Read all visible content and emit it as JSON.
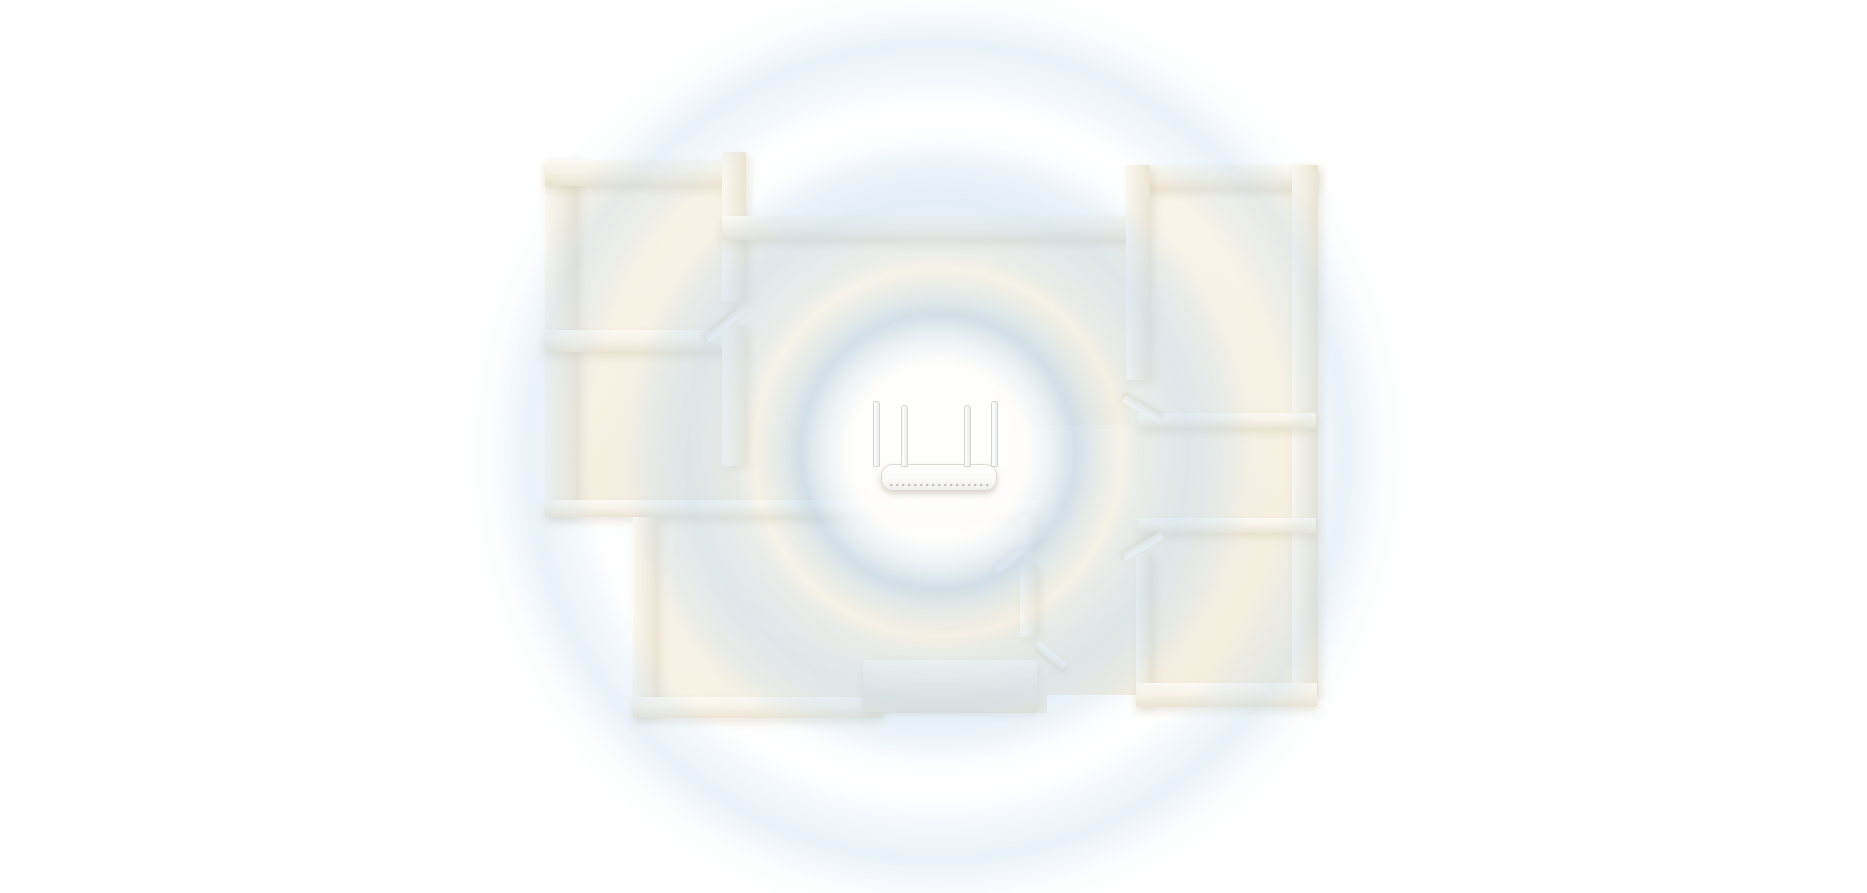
{
  "meta": {
    "description": "Top-down 3D floor plan of an apartment with a white dual-band WiFi router placed in the central room, radiating concentric light-blue wireless signal rings that cover every room. No text is present in the image.",
    "canvas": {
      "width": 1867,
      "height": 893
    },
    "background": "#ffffff"
  },
  "palette": {
    "floor": "#f7f0df",
    "floor_bright": "#fdf8ec",
    "wall_top": "#faf6ec",
    "wall_side": "#e9e1cc",
    "wall_shadow": "rgba(188,174,140,0.3)",
    "signal_blue": "#c5ddf2",
    "signal_blue_soft": "#dcebf7",
    "inner_zone_white": "#ffffff",
    "router_body": "#ffffff",
    "router_edge": "#dcdad3"
  },
  "signal": {
    "center_x": 938,
    "center_y": 452,
    "outer_radius": 470,
    "rings": [
      {
        "name": "inner-white-zone",
        "inner": 0,
        "peak": 40,
        "outer": 80
      },
      {
        "name": "ring-1-rim",
        "inner": 80,
        "peak": 97,
        "outer": 130
      },
      {
        "name": "ring-2",
        "inner": 138,
        "peak": 177,
        "outer": 222
      },
      {
        "name": "ring-3",
        "inner": 262,
        "peak": 289,
        "outer": 318
      },
      {
        "name": "ring-4",
        "inner": 400,
        "peak": 416,
        "outer": 436
      }
    ],
    "gradient_stops": [
      [
        0,
        "rgba(255,255,255,0.95)"
      ],
      [
        62,
        "rgba(255,255,255,0.90)"
      ],
      [
        80,
        "rgba(234,243,250,0.80)"
      ],
      [
        97,
        "rgba(185,213,238,0.60)"
      ],
      [
        112,
        "rgba(203,225,243,0.42)"
      ],
      [
        130,
        "rgba(240,247,252,0.22)"
      ],
      [
        142,
        "rgba(213,231,246,0.40)"
      ],
      [
        177,
        "rgba(197,221,242,0.50)"
      ],
      [
        205,
        "rgba(208,227,244,0.38)"
      ],
      [
        222,
        "rgba(238,246,252,0.16)"
      ],
      [
        245,
        "rgba(252,253,254,0.12)"
      ],
      [
        262,
        "rgba(217,233,247,0.30)"
      ],
      [
        289,
        "rgba(201,223,242,0.40)"
      ],
      [
        318,
        "rgba(235,244,251,0.14)"
      ],
      [
        362,
        "rgba(252,253,254,0.08)"
      ],
      [
        400,
        "rgba(216,232,246,0.26)"
      ],
      [
        416,
        "rgba(206,226,244,0.32)"
      ],
      [
        436,
        "rgba(228,240,249,0.16)"
      ],
      [
        468,
        "rgba(255,255,255,0)"
      ]
    ]
  },
  "floorplan": {
    "floors": [
      {
        "name": "room-top-left",
        "x": 548,
        "y": 170,
        "w": 192,
        "h": 345
      },
      {
        "name": "room-center",
        "x": 740,
        "y": 228,
        "w": 400,
        "h": 285
      },
      {
        "name": "rooms-right-column",
        "x": 1130,
        "y": 175,
        "w": 180,
        "h": 520
      },
      {
        "name": "room-bottom-left",
        "x": 645,
        "y": 505,
        "w": 402,
        "h": 208
      },
      {
        "name": "corridor-right",
        "x": 1037,
        "y": 425,
        "w": 100,
        "h": 270
      }
    ],
    "walls": [
      {
        "name": "outer-left",
        "x": 545,
        "y": 160,
        "w": 32,
        "h": 357,
        "o": "v"
      },
      {
        "name": "top-left-room-top",
        "x": 545,
        "y": 160,
        "w": 180,
        "h": 26,
        "o": "h"
      },
      {
        "name": "left-rooms-divider",
        "x": 545,
        "y": 330,
        "w": 198,
        "h": 22,
        "o": "h"
      },
      {
        "name": "center-vertical-upper",
        "x": 722,
        "y": 152,
        "w": 24,
        "h": 150,
        "o": "v"
      },
      {
        "name": "center-vertical-lower",
        "x": 722,
        "y": 326,
        "w": 24,
        "h": 140,
        "o": "v"
      },
      {
        "name": "center-room-top",
        "x": 722,
        "y": 216,
        "w": 420,
        "h": 24,
        "o": "h"
      },
      {
        "name": "top-right-room-top",
        "x": 1138,
        "y": 165,
        "w": 180,
        "h": 24,
        "o": "h"
      },
      {
        "name": "outer-right",
        "x": 1292,
        "y": 165,
        "w": 26,
        "h": 532,
        "o": "v"
      },
      {
        "name": "top-right-room-left",
        "x": 1126,
        "y": 165,
        "w": 24,
        "h": 215,
        "o": "v"
      },
      {
        "name": "right-divider-upper",
        "x": 1138,
        "y": 413,
        "w": 178,
        "h": 15,
        "o": "h"
      },
      {
        "name": "right-divider-lower",
        "x": 1138,
        "y": 518,
        "w": 178,
        "h": 15,
        "o": "h"
      },
      {
        "name": "bottom-right-room-left",
        "x": 1136,
        "y": 553,
        "w": 15,
        "h": 152,
        "o": "v"
      },
      {
        "name": "bottom-right-room-bottom",
        "x": 1136,
        "y": 683,
        "w": 181,
        "h": 24,
        "o": "h"
      },
      {
        "name": "middle-horizontal",
        "x": 545,
        "y": 500,
        "w": 492,
        "h": 17,
        "o": "h"
      },
      {
        "name": "bottom-center-vert-a",
        "x": 1020,
        "y": 517,
        "w": 17,
        "h": 28,
        "o": "v"
      },
      {
        "name": "bottom-center-vert-b",
        "x": 1020,
        "y": 565,
        "w": 17,
        "h": 72,
        "o": "v"
      },
      {
        "name": "bottom-left-room-left",
        "x": 633,
        "y": 517,
        "w": 24,
        "h": 200,
        "o": "v"
      },
      {
        "name": "bottom-left-room-bottom",
        "x": 633,
        "y": 697,
        "w": 250,
        "h": 21,
        "o": "h"
      },
      {
        "name": "bottom-center-block",
        "x": 863,
        "y": 660,
        "w": 174,
        "h": 52,
        "o": "block"
      }
    ],
    "doors": [
      {
        "name": "door-top-left-room",
        "x": 742,
        "y": 306,
        "len": 46,
        "angle": 140
      },
      {
        "name": "door-top-right-room",
        "x": 1162,
        "y": 416,
        "len": 44,
        "angle": 210
      },
      {
        "name": "door-middle-right-room",
        "x": 1162,
        "y": 531,
        "len": 44,
        "angle": 150
      },
      {
        "name": "door-bottom-center-a",
        "x": 1022,
        "y": 545,
        "len": 34,
        "angle": 140
      },
      {
        "name": "door-bottom-center-b",
        "x": 1037,
        "y": 640,
        "len": 36,
        "angle": 40
      }
    ]
  },
  "router": {
    "center_x": 938,
    "body": {
      "x": 881,
      "y": 464,
      "w": 114,
      "h": 25
    },
    "antennas": [
      {
        "dx": -8,
        "top_y": 401,
        "h": 64
      },
      {
        "dx": 20,
        "top_y": 405,
        "h": 60
      },
      {
        "dx": 83,
        "top_y": 405,
        "h": 60
      },
      {
        "dx": 110,
        "top_y": 401,
        "h": 64
      }
    ],
    "antenna_count": 4
  }
}
